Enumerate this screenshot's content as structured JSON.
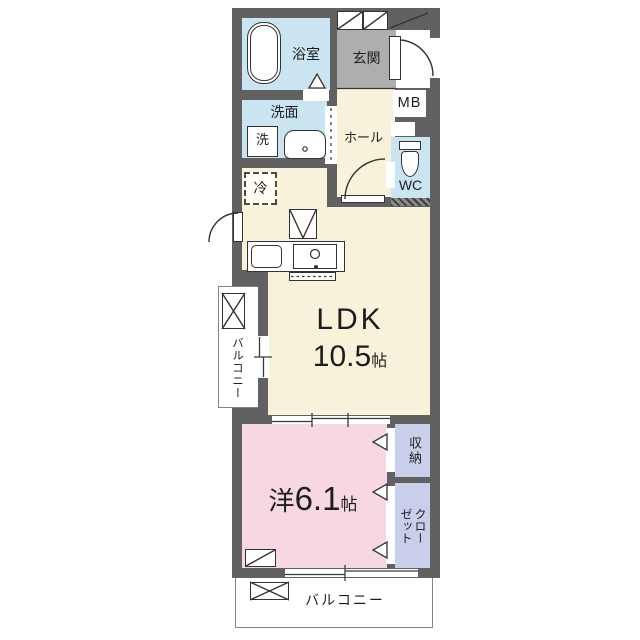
{
  "document": {
    "type": "apartment-floor-plan"
  },
  "colors": {
    "wall": "#616161",
    "ldk_floor": "#f9f2da",
    "bedroom_floor": "#f7d7e1",
    "wet_area": "#cbe4f1",
    "entrance_tile": "#aeaeae",
    "closet_fill": "#c9cfea",
    "line": "#333333"
  },
  "rooms": {
    "bath": {
      "label": "浴室"
    },
    "washroom": {
      "label": "洗面"
    },
    "washer": {
      "label": "洗"
    },
    "entrance": {
      "label": "玄関"
    },
    "meter_box": {
      "label": "MB"
    },
    "hall": {
      "label": "ホール"
    },
    "toilet": {
      "label": "WC"
    },
    "fridge": {
      "label": "冷"
    },
    "ldk": {
      "label": "LDK",
      "size": "10.5",
      "unit": "帖"
    },
    "balcony_left": {
      "label": "バルコニー"
    },
    "bedroom": {
      "label": "洋",
      "size": "6.1",
      "unit": "帖"
    },
    "storage": {
      "label": "収納"
    },
    "closet": {
      "label": "クローゼット",
      "lines": [
        "クロー",
        "ゼット"
      ]
    },
    "balcony_bottom": {
      "label": "バルコニー"
    }
  }
}
